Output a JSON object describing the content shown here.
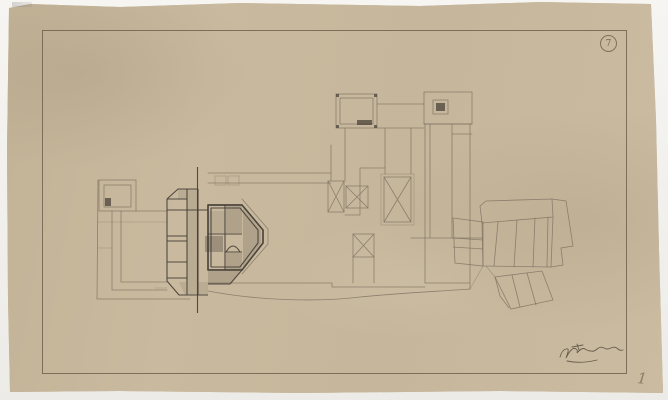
{
  "sheet": {
    "stamp_mark": "7",
    "corner_number": "1"
  },
  "colors": {
    "paper": "#c7b79c",
    "paper_edge": "#f2f1ee",
    "border_line": "#6e6150",
    "pencil_faint": "#7d7161",
    "pencil_dark": "#474038",
    "graphite_fill": "#6f675a"
  }
}
